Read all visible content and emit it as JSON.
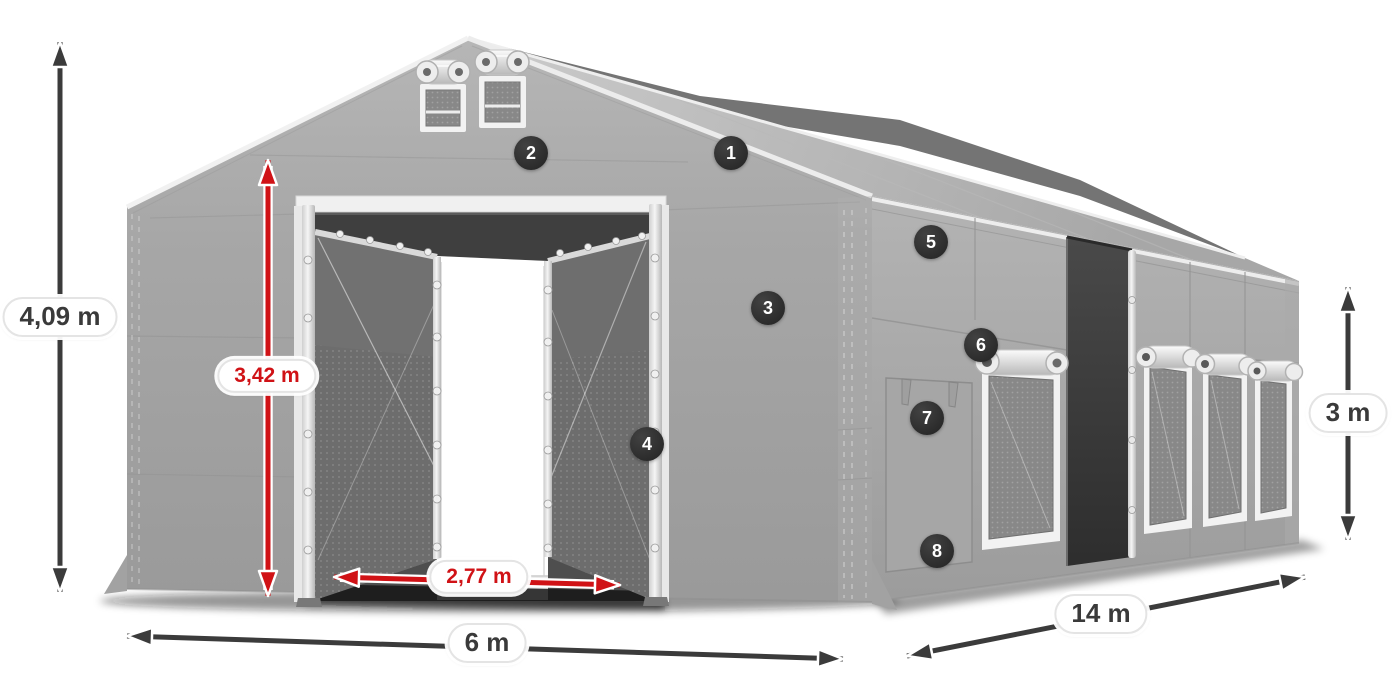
{
  "figure": {
    "type": "product-dimension-diagram",
    "subject": "Gray PVC storage tent, 6 x 14 m, perspective render with numbered feature callouts"
  },
  "dimension_labels": {
    "total_height": {
      "text": "4,09 m",
      "color": "#3a3a3a",
      "measures": "total height"
    },
    "entrance_height": {
      "text": "3,42 m",
      "color": "#d01216",
      "measures": "entrance height"
    },
    "entrance_width": {
      "text": "2,77 m",
      "color": "#d01216",
      "measures": "entrance width"
    },
    "front_width": {
      "text": "6 m",
      "color": "#3a3a3a",
      "measures": "tent width"
    },
    "side_length": {
      "text": "14 m",
      "color": "#3a3a3a",
      "measures": "tent length"
    },
    "side_height": {
      "text": "3 m",
      "color": "#3a3a3a",
      "measures": "side wall height"
    }
  },
  "feature_callouts": [
    {
      "number": "1"
    },
    {
      "number": "2"
    },
    {
      "number": "3"
    },
    {
      "number": "4"
    },
    {
      "number": "5"
    },
    {
      "number": "6"
    },
    {
      "number": "7"
    },
    {
      "number": "8"
    }
  ],
  "colors": {
    "arrow_dark": "#3b3b3b",
    "arrow_red": "#d01216",
    "badge_background": "#2b2b2b",
    "badge_text": "#ffffff",
    "label_background": "#ffffff",
    "tent_gray": "#a6a6a6"
  }
}
